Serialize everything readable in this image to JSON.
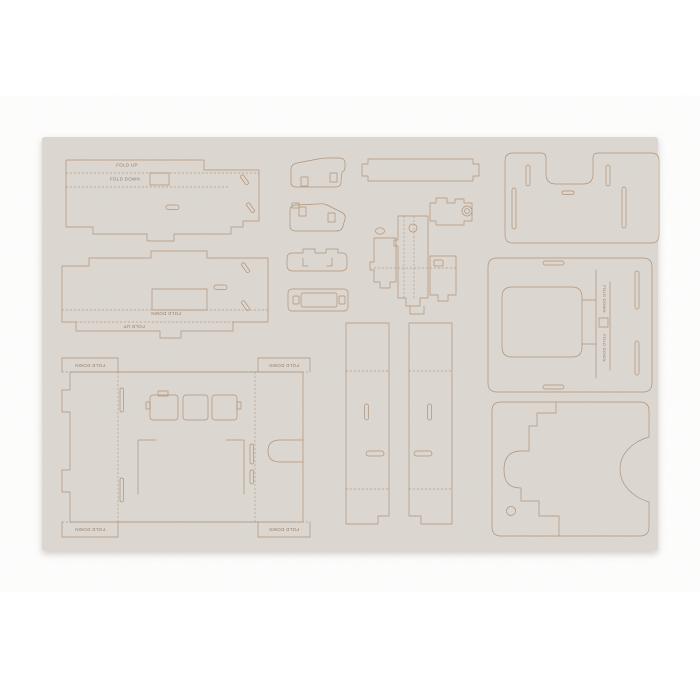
{
  "colors": {
    "background": "#ffffff",
    "sheet": "#dcd8d2",
    "cut_line": "#ad8b6c",
    "label_text": "#997a5f",
    "shadow": "#9f9c98"
  },
  "labels": {
    "items": [
      {
        "text": "FOLD UP"
      },
      {
        "text": "FOLD DOWN"
      },
      {
        "text": "FOLD DOWN"
      },
      {
        "text": "FOLD UP"
      },
      {
        "text": "FOLD DOWN"
      },
      {
        "text": "FOLD DOWN"
      },
      {
        "text": "FOLD DOWN"
      },
      {
        "text": "FOLD DOWN"
      },
      {
        "text": "FOLD DOWN"
      },
      {
        "text": "FOLD DOWN"
      }
    ]
  }
}
